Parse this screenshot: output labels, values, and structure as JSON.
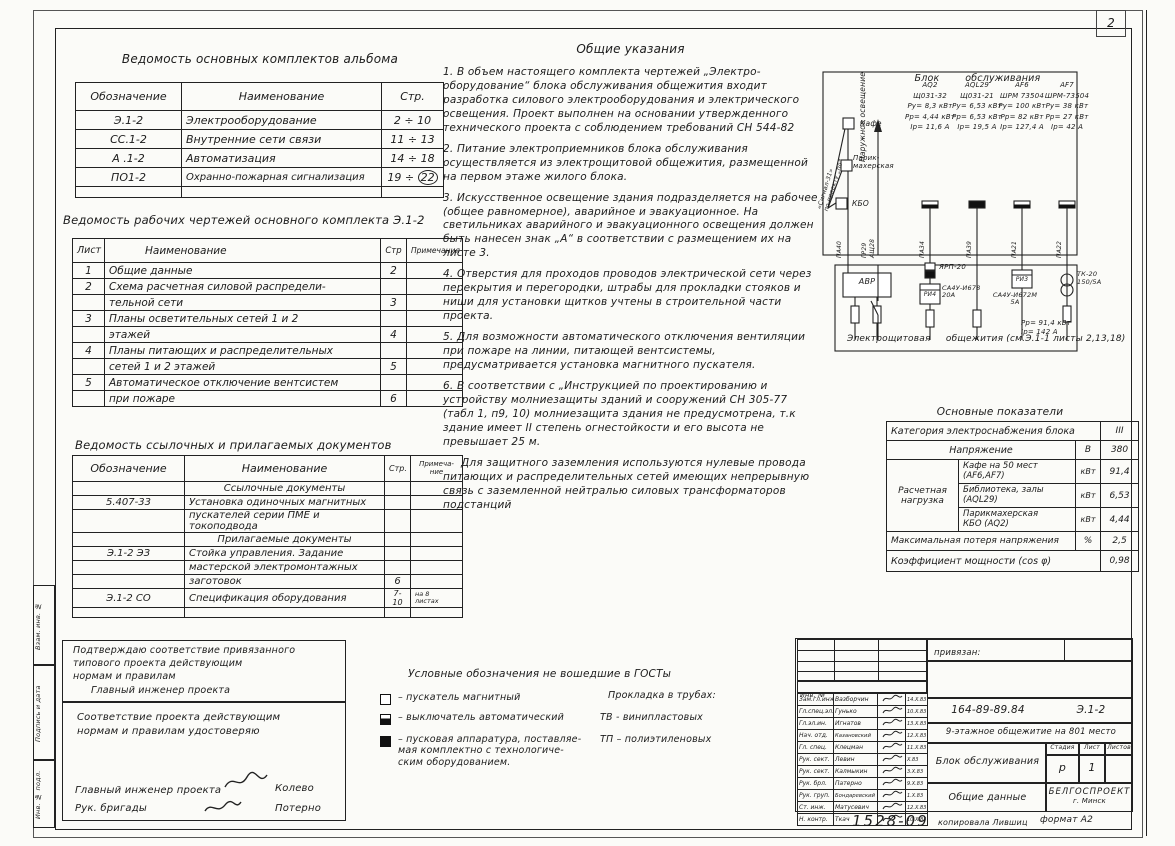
{
  "page": {
    "sheet_number": "2",
    "doc_number_hand": "1528-09",
    "copy_note": "копировала Лившиц",
    "format_note": "формат А2"
  },
  "margin_fields": [
    "Взам. инв. №",
    "Подпись и дата",
    "Инв. № подл."
  ],
  "tables": {
    "album": {
      "title": "Ведомость  основных  комплектов  альбома",
      "headers": [
        "Обозначение",
        "Наименование",
        "Стр."
      ],
      "rows": [
        [
          "Э.1-2",
          "Электрооборудование",
          "2 ÷ 10"
        ],
        [
          "СС.1-2",
          "Внутренние  сети  связи",
          "11 ÷ 13"
        ],
        [
          "А .1-2",
          "Автоматизация",
          "14 ÷ 18"
        ],
        [
          "ПО1-2",
          "Охранно-пожарная  сигнализация",
          "19 ÷"
        ]
      ],
      "circled": "22"
    },
    "working": {
      "title": "Ведомость  рабочих  чертежей  основного  комплекта  Э.1-2",
      "headers": [
        "Лист",
        "Наименование",
        "Стр",
        "Примечания"
      ],
      "lines": [
        [
          "1",
          "Общие   данные",
          "2",
          ""
        ],
        [
          "2",
          "Схема   расчетная  силовой  распредели-",
          "",
          ""
        ],
        [
          "",
          "тельной   сети",
          "3",
          ""
        ],
        [
          "3",
          "Планы   осветительных  сетей  1 и 2",
          "",
          ""
        ],
        [
          "",
          "этажей",
          "4",
          ""
        ],
        [
          "4",
          "Планы  питающих  и  распределительных",
          "",
          ""
        ],
        [
          "",
          "сетей   1  и  2  этажей",
          "5",
          ""
        ],
        [
          "5",
          "Автоматическое  отключение  вентсистем",
          "",
          ""
        ],
        [
          "",
          "при   пожаре",
          "6",
          ""
        ]
      ]
    },
    "reference": {
      "title": "Ведомость  ссылочных  и  прилагаемых  документов",
      "headers": [
        "Обозначение",
        "Наименование",
        "Стр.",
        "Примеча-\nние"
      ],
      "lines": [
        [
          "",
          "Ссылочные  документы",
          "",
          ""
        ],
        [
          "5.407-33",
          "Установка одиночных магнитных",
          "",
          ""
        ],
        [
          "",
          "пускателей серии ПМЕ и токоподвода",
          "",
          ""
        ],
        [
          "",
          "Прилагаемые  документы",
          "",
          ""
        ],
        [
          "Э.1-2 ЭЗ",
          "Стойка управления. Задание",
          "",
          ""
        ],
        [
          "",
          "мастерской электромонтажных",
          "",
          ""
        ],
        [
          "",
          "заготовок",
          "6",
          ""
        ],
        [
          "Э.1-2 СО",
          "Спецификация  оборудования",
          "7-10",
          "на 8\nлистах"
        ],
        [
          "",
          "",
          "",
          ""
        ]
      ]
    }
  },
  "notes": {
    "title": "Общие  указания",
    "items": [
      "1. В объем настоящего комплекта чертежей „Электро-оборудование“ блока обслуживания общежития входит разработка силового электрооборудования и электрического освещения. Проект выполнен на основании утвержденного технического проекта с соблюдением требований СН 544-82",
      "2. Питание электроприемников блока обслуживания осуществляется из электрощитовой общежития, размещенной на первом этаже жилого блока.",
      "3. Искусственное освещение здания подразделяется на рабочее (общее равномерное), аварийное и эвакуационное. На светильниках аварийного и эвакуационного освещения должен быть нанесен знак „А“ в соответствии с размещением их на листе 3.",
      "4. Отверстия для проходов проводов электрической сети через перекрытия и перегородки, штрабы для прокладки стояков и ниши для установки щитков учтены в строительной части проекта.",
      "5. Для возможности автоматического отключения вентиляции при пожаре на линии, питающей вентсистемы, предусматривается установка магнитного пускателя.",
      "6. В соответствии с „Инструкцией по проектированию и устройству молниезащиты зданий и сооружений СН 305-77 (табл 1, п9, 10) молниезащита здания не предусмотрена, т.к здание имеет II степень огнестойкости и его высота не превышает 25 м."
    ],
    "final_note": "Для защитного заземления используются нулевые провода питающих и распределительных сетей имеющих непрерывную связь с заземленной нейтралью силовых трансформаторов подстанций"
  },
  "diagram": {
    "title": "Блок        обслуживания",
    "signal_label": "«Сигнал-31»\nпо проекту „по“",
    "outdoor_label": "Наружное освещение",
    "nodes": [
      "Кафе",
      "Парик-\nмахерская",
      "КБО"
    ],
    "feeders": [
      {
        "name": "АQ2",
        "panel": "Щ031-32",
        "pu": "Ру= 8,3 кВт",
        "pp": "Рр= 4,44 кВт",
        "ip": "Iр= 11,6 А"
      },
      {
        "name": "АQL29",
        "panel": "Щ031-21",
        "pu": "Ру= 6,53 кВт",
        "pp": "Рр= 6,53 кВт",
        "ip": "Iр= 19,5 А"
      },
      {
        "name": "АF6",
        "panel": "ШРМ 73504",
        "pu": "Ру= 100 кВт",
        "pp": "Рр= 82 кВт",
        "ip": "Iр= 127,4 А"
      },
      {
        "name": "АF7",
        "panel": "ШРМ-73504",
        "pu": "Ру= 38 кВт",
        "pp": "Рр= 27 кВт",
        "ip": "Iр= 42 А"
      }
    ],
    "line_labels": [
      "ПА40",
      "ГР29",
      "АЩ28",
      "ПА34",
      "ПА39",
      "ПА21",
      "ПА22"
    ],
    "avr": "АВР",
    "yarp": "ЯРП-20",
    "meter1": "РИ4",
    "meter1_note": "СА4У-И678\n20А",
    "meter2": "РИ3",
    "meter2_note": "СА4У-И672М\n5А",
    "tk": "ТК-20\n150/5А",
    "totals": "Рр= 91,4 кВт\nIр= 142 А",
    "caption": "Электрощитовая     общежития (см.Э.1-1 листы 2,13,18)"
  },
  "indicators": {
    "title": "Основные    показатели",
    "category_label": "Категория  электроснабжения  блока",
    "category_value": "III",
    "voltage_label": "Напряжение",
    "voltage_unit": "В",
    "voltage_value": "380",
    "load_label": "Расчетная\nнагрузка",
    "loads": [
      {
        "label": "Кафе на 50 мест (АF6,АF7)",
        "unit": "кВт",
        "value": "91,4"
      },
      {
        "label": "Библиотека, залы\n(АQL29)",
        "unit": "кВт",
        "value": "6,53"
      },
      {
        "label": "Парикмахерская\nКБО  (АQ2)",
        "unit": "кВт",
        "value": "4,44"
      }
    ],
    "loss_label": "Максимальная  потеря  напряжения",
    "loss_unit": "%",
    "loss_value": "2,5",
    "cos_label": "Коэффициент  мощности   (cos φ)",
    "cos_value": "0,98"
  },
  "approvals": {
    "statement1": "Подтверждаю   соответствие   привязанного\nтипового   проекта   действующим\nнормам   и   правилам",
    "role1": "Главный  инженер  проекта",
    "statement2": "Соответствие  проекта  действующим\nнормам  и  правилам  удостоверяю",
    "role2a": "Главный  инженер  проекта",
    "name2a": "Колево",
    "role2b": "Рук. бригады",
    "name2b": "Потерно"
  },
  "legend": {
    "title": "Условные  обозначения   не  вошедшие   в  ГОСТы",
    "items": [
      "–  пускатель  магнитный",
      "–  выключатель  автоматический",
      "–  пусковая  аппаратура, поставляе-\nмая  комплектно с  технологиче-\nским  оборудованием."
    ],
    "tubes_title": "Прокладка  в  трубах:",
    "tubes": [
      {
        "code": "ТВ -",
        "label": "винипластовых"
      },
      {
        "code": "ТП –",
        "label": "полиэтиленовых"
      }
    ]
  },
  "stamp": {
    "pin_label": "привязан:",
    "inv_label": "Инв. №",
    "project_code": "164-89-89.84",
    "doc_code": "Э.1-2",
    "building": "9-этажное  общежитие  на 801  место",
    "object": "Блок  обслуживания",
    "content": "Общие  данные",
    "stage_label": "Стадия",
    "sheet_label": "Лист",
    "sheets_label": "Листов",
    "stage": "р",
    "sheet": "1",
    "sheets": "",
    "org": "БЕЛГОСПРОЕКТ",
    "city": "г.  Минск",
    "sign_rows": [
      {
        "role": "Зам.гл.инж.",
        "name": "Вазборчин",
        "date": "14.X.83"
      },
      {
        "role": "Гл.спец.эл.",
        "name": "Гунько",
        "date": "10.X.83"
      },
      {
        "role": "Гл.эл.ин.",
        "name": "Игнатов",
        "date": "13.X.83"
      },
      {
        "role": "Нач. отд.",
        "name": "Казановский",
        "date": "12.X.83"
      },
      {
        "role": "Гл. спец.",
        "name": "Клецман",
        "date": "11.X.83"
      },
      {
        "role": "Рук. сект.",
        "name": "Левин",
        "date": "X.83"
      },
      {
        "role": "Рук. сект.",
        "name": "Калмыкин",
        "date": "3.X.83"
      },
      {
        "role": "Рук. брл.",
        "name": "Патерно",
        "date": "9.X.83"
      },
      {
        "role": "Рук. груп.",
        "name": "Бондаревский",
        "date": "1.X.83"
      },
      {
        "role": "Ст. инж.",
        "name": "Матусевич",
        "date": "12.X.83"
      },
      {
        "role": "Н. контр.",
        "name": "Ткач",
        "date": "10.X.83"
      }
    ]
  }
}
